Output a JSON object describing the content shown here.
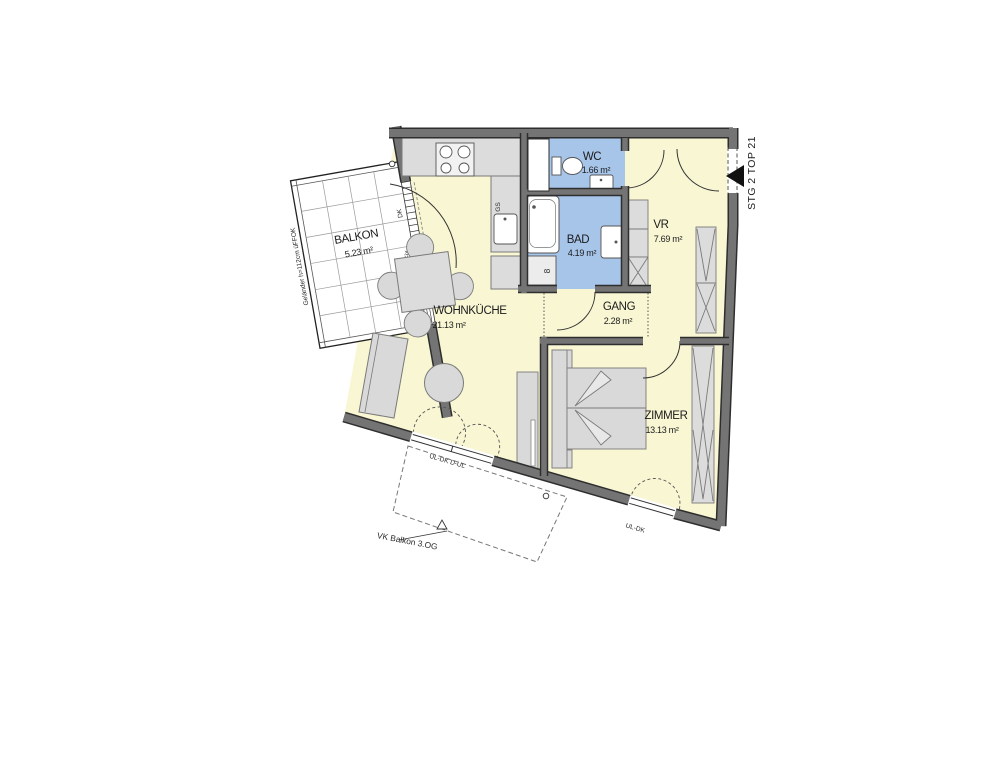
{
  "plan": {
    "rooms": {
      "balkon": {
        "name": "BALKON",
        "area": "5.23 m²"
      },
      "wohnkueche": {
        "name": "WOHNKÜCHE",
        "area": "21.13 m²"
      },
      "wc": {
        "name": "WC",
        "area": "1.66 m²"
      },
      "bad": {
        "name": "BAD",
        "area": "4.19 m²"
      },
      "vr": {
        "name": "VR",
        "area": "7.69 m²"
      },
      "gang": {
        "name": "GANG",
        "area": "2.28 m²"
      },
      "zimmer": {
        "name": "ZIMMER",
        "area": "13.13 m²"
      }
    },
    "labels": {
      "entrance": "STG 2 TOP 21",
      "railing": "Geländer h=112cm üFFOK",
      "balcony_above": "VK Balkon 3.OG",
      "window_main": "UL-DK D-UL",
      "window_room": "UL-DK",
      "fixed_glazing": "Fix",
      "tilt_turn": "DK",
      "dishwasher": "GS",
      "washer": "8"
    },
    "colors": {
      "room_fill": "#F8F6D3",
      "wet_room_fill": "#A7C4E9",
      "wall": "#747474",
      "wall_edge": "#2E2E2E",
      "furniture": "#D9D9D9"
    }
  }
}
